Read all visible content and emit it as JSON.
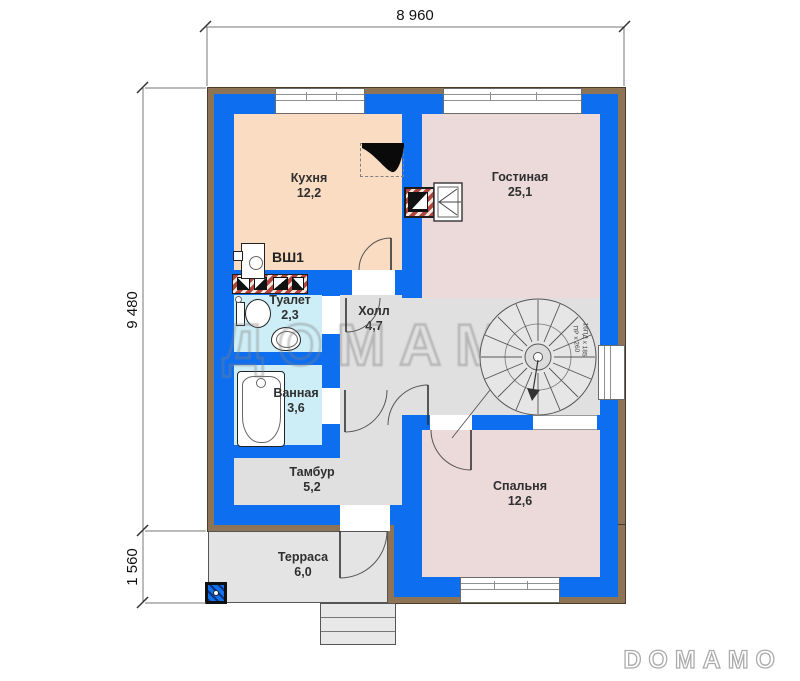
{
  "title": "Floor plan",
  "dimensions": {
    "width_top": "8 960",
    "height_main": "9 480",
    "terrace_depth": "1 560"
  },
  "rooms": {
    "kitchen": {
      "name": "Кухня",
      "area": "12,2"
    },
    "living": {
      "name": "Гостиная",
      "area": "25,1"
    },
    "toilet": {
      "name": "Туалет",
      "area": "2,3"
    },
    "hall": {
      "name": "Холл",
      "area": "4,7"
    },
    "bathroom": {
      "name": "Ванная",
      "area": "3,6"
    },
    "vestibule": {
      "name": "Тамбур",
      "area": "5,2"
    },
    "bedroom": {
      "name": "Спальня",
      "area": "12,6"
    },
    "terrace": {
      "name": "Терраса",
      "area": "6,0"
    }
  },
  "annotations": {
    "vent_shaft": "ВШ1",
    "stair_note_right": "16ПД x 185",
    "stair_note_left": "ПР x 260"
  },
  "watermark": {
    "center": "ДОМАМО",
    "corner": "DOMAMO"
  },
  "colors": {
    "wall_insulation": "#0d6ef0",
    "wall_cladding": "#8d7456",
    "kitchen_fill": "#fadcc3",
    "living_fill": "#ecd9da",
    "wet_room_fill": "#cdeef7",
    "circulation_fill": "#e0e0e0",
    "brick_hatch": "#b2443c"
  }
}
